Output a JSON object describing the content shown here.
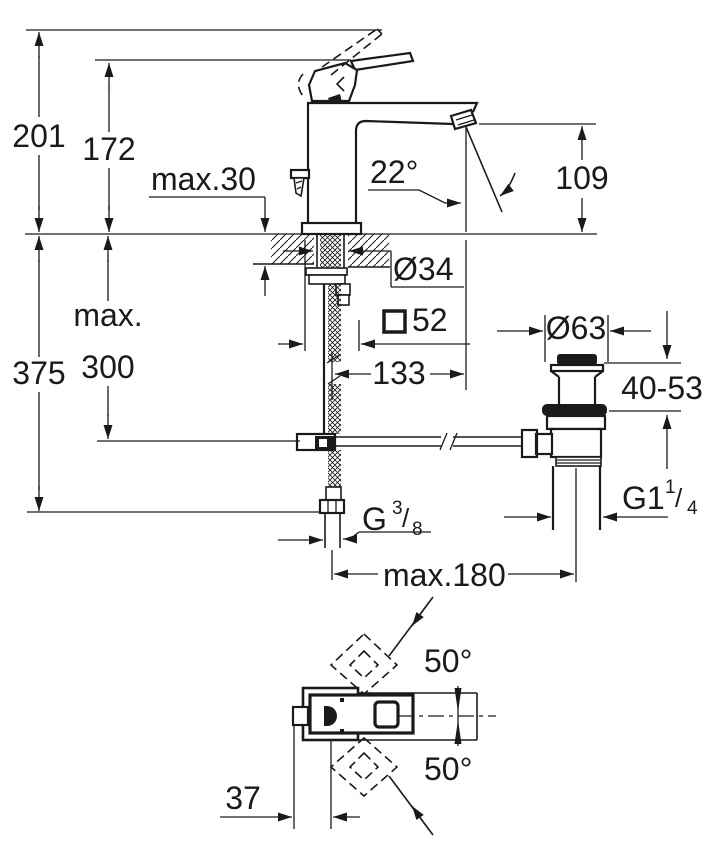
{
  "colors": {
    "line": "#1a1a1a",
    "background": "#ffffff"
  },
  "labels": {
    "total_height": "201",
    "lever_height": "172",
    "deck_thickness": "max.30",
    "supply_length": "375",
    "hose_max_word": "max.",
    "hose_max_value": "300",
    "spout_angle": "22°",
    "spout_height": "109",
    "hole_diameter": "Ø34",
    "body_square_size": "52",
    "spout_reach": "133",
    "waste_flange_diameter": "Ø63",
    "clamp_range": "40-53",
    "supply_thread_prefix": "G",
    "supply_thread_sup": "3",
    "supply_thread_slash": "/",
    "supply_thread_sub": "8",
    "waste_thread_prefix": "G1",
    "waste_thread_sup": "1",
    "waste_thread_slash": "/",
    "waste_thread_sub": "4",
    "max_center_distance": "max.180",
    "handle_swing_upper": "50°",
    "handle_swing_lower": "50°",
    "back_to_center": "37"
  }
}
